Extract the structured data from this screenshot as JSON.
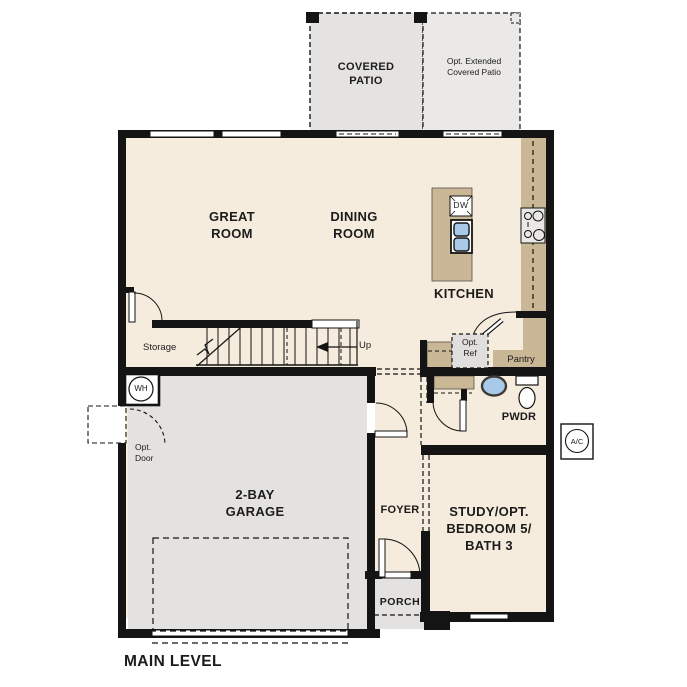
{
  "title": "MAIN LEVEL",
  "rooms": {
    "covered_patio": "COVERED\nPATIO",
    "opt_extended_patio": "Opt. Extended\nCovered Patio",
    "great_room": "GREAT\nROOM",
    "dining_room": "DINING\nROOM",
    "kitchen": "KITCHEN",
    "garage": "2-BAY\nGARAGE",
    "foyer": "FOYER",
    "porch": "PORCH",
    "study": "STUDY/OPT.\nBEDROOM 5/\nBATH 3",
    "powder": "PWDR",
    "pantry": "Pantry",
    "storage": "Storage"
  },
  "annotations": {
    "up": "Up",
    "opt_door": "Opt.\nDoor",
    "opt_ref": "Opt.\nRef",
    "water_heater": "WH",
    "ac_unit": "A/C",
    "dishwasher": "DW"
  },
  "palette": {
    "floor": "#f5ecdd",
    "garage_gray": "#e3e2e0",
    "patio_gray": "#e4e3e1",
    "extended_patio_gray": "#eaE9e7",
    "counter_tan": "#c9b795",
    "sink_blue": "#a9c9e9",
    "wall_black": "#141414",
    "fixture_gray": "#e9e8e6"
  }
}
